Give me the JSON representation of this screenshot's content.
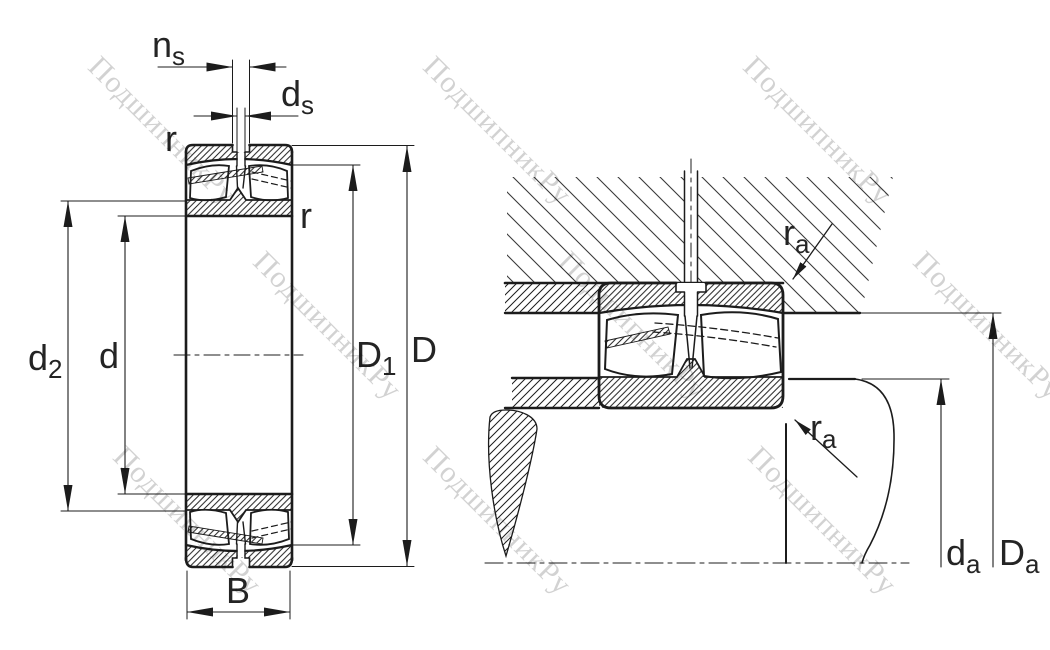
{
  "figure": {
    "type": "technical-drawing",
    "subject": "Spherical roller bearing: cross-section and mounting/abutment dimensions",
    "left_view": "bearing cross-section with boundary dimensions",
    "right_view": "bearing mounted in housing on shaft with abutment dimensions"
  },
  "labels": {
    "ns": {
      "main": "n",
      "sub": "s"
    },
    "ds": {
      "main": "d",
      "sub": "s"
    },
    "r_left": "r",
    "r_right": "r",
    "d2": {
      "main": "d",
      "sub": "2"
    },
    "d": "d",
    "D1": {
      "main": "D",
      "sub": "1"
    },
    "D": "D",
    "B": "B",
    "ra_top": {
      "main": "r",
      "sub": "a"
    },
    "ra_bottom": {
      "main": "r",
      "sub": "a"
    },
    "da": {
      "main": "d",
      "sub": "a"
    },
    "Da": {
      "main": "D",
      "sub": "a"
    }
  },
  "watermark": {
    "text": "ПодшипникРу",
    "color": "#d2d2d2"
  },
  "colors": {
    "line": "#1c1c1c",
    "label": "#242424",
    "housing_hatch": "#3a3a3a",
    "background": "#ffffff"
  }
}
